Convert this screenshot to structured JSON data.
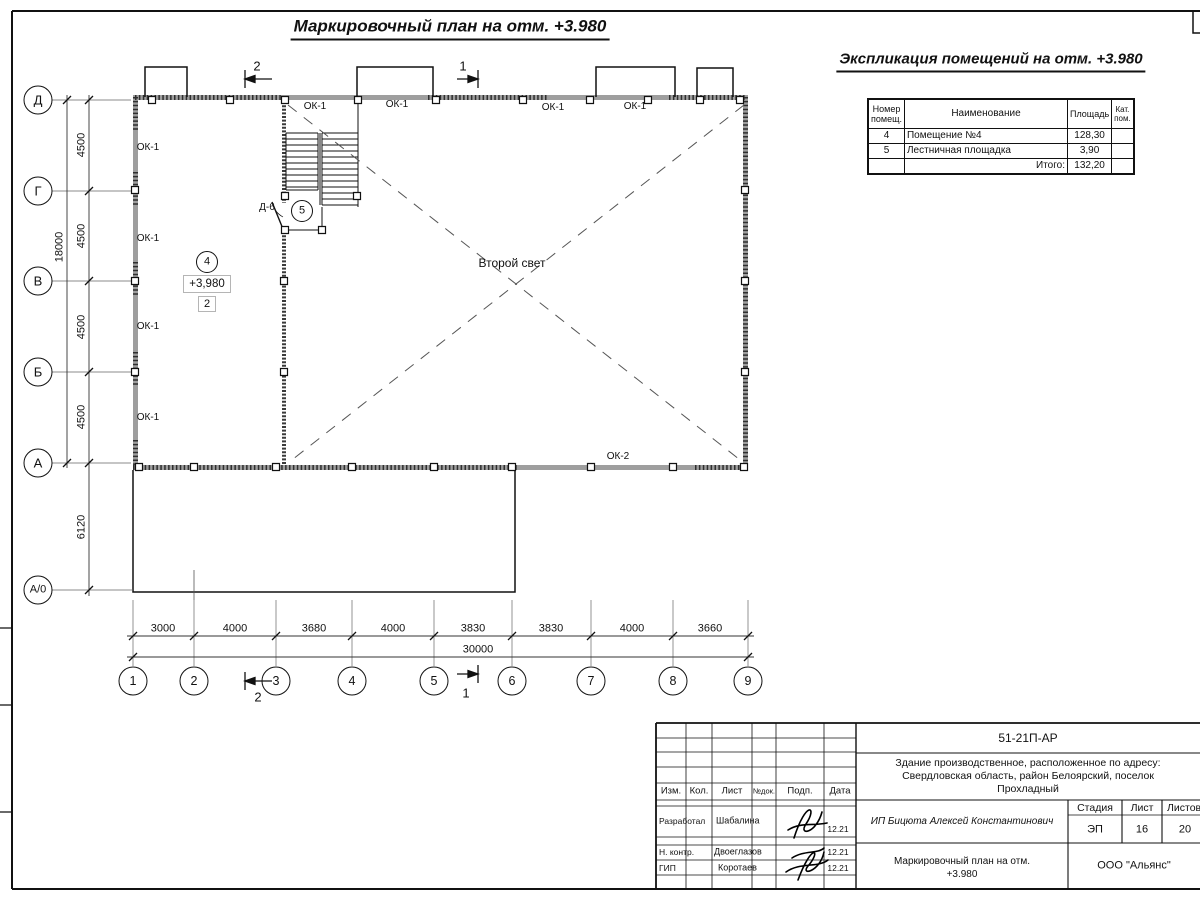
{
  "plan_title": "Маркировочный план на отм. +3.980",
  "explication": {
    "title": "Экспликация помещений на отм. +3.980",
    "col_number_l1": "Номер",
    "col_number_l2": "помещ.",
    "col_name": "Наименование",
    "col_area": "Площадь",
    "col_cat_l1": "Кат.",
    "col_cat_l2": "пом.",
    "rows": [
      {
        "num": "4",
        "name": "Помещение №4",
        "area": "128,30"
      },
      {
        "num": "5",
        "name": "Лестничная площадка",
        "area": "3,90"
      }
    ],
    "total_label": "Итого:",
    "total_value": "132,20"
  },
  "plan": {
    "second_light": "Второй свет",
    "elevation": "+3,980",
    "floor_box": "2",
    "room4_tag": "4",
    "room5_tag": "5",
    "door_label": "Д-6",
    "ok1": "ОК-1",
    "ok2": "ОК-2"
  },
  "axes": {
    "horizontal": [
      "1",
      "2",
      "3",
      "4",
      "5",
      "6",
      "7",
      "8",
      "9"
    ],
    "vertical": [
      "Д",
      "Г",
      "В",
      "Б",
      "А",
      "А/0"
    ]
  },
  "dims": {
    "bottom": [
      "3000",
      "4000",
      "3680",
      "4000",
      "3830",
      "3830",
      "4000",
      "3660"
    ],
    "bottom_total": "30000",
    "left": [
      "4500",
      "4500",
      "4500",
      "4500"
    ],
    "left_total": "18000",
    "left_annex": "6120"
  },
  "sections": {
    "s1": "1",
    "s2": "2"
  },
  "stamp": {
    "code": "51-21П-АР",
    "object_l1": "Здание производственное, расположенное по адресу:",
    "object_l2": "Свердловская область, район Белоярский, поселок",
    "object_l3": "Прохладный",
    "client": "ИП Бицюта Алексей Константинович",
    "stage_label": "Стадия",
    "sheet_label": "Лист",
    "sheets_label": "Листов",
    "stage": "ЭП",
    "sheet": "16",
    "sheets": "20",
    "drawing_l1": "Маркировочный план на отм.",
    "drawing_l2": "+3.980",
    "company": "ООО \"Альянс\"",
    "h_izm": "Изм.",
    "h_kol": "Кол.",
    "h_list": "Лист",
    "h_ndoc": "№док.",
    "h_podp": "Подп.",
    "h_data": "Дата",
    "sig_rows": [
      {
        "role": "Разработал",
        "name": "Шабалина",
        "date": "12.21"
      },
      {
        "role": "Н. контр.",
        "name": "Двоеглазов",
        "date": "12.21"
      },
      {
        "role": "ГИП",
        "name": "Коротаев",
        "date": "12.21"
      }
    ]
  }
}
